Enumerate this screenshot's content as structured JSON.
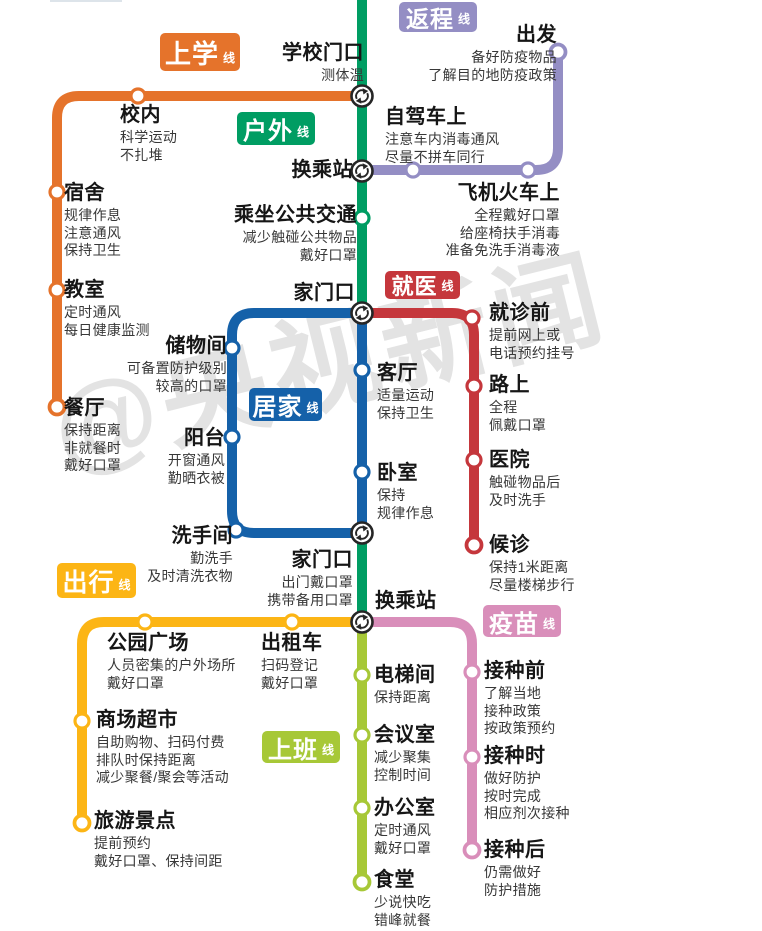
{
  "watermark": "@央视新闻",
  "badge_suffix": "线",
  "lines": {
    "school": {
      "badge": "上学",
      "color": "#E5732B",
      "stations": [
        {
          "name": "学校门口",
          "tips": [
            "测体温"
          ]
        },
        {
          "name": "校内",
          "tips": [
            "科学运动",
            "不扎堆"
          ]
        },
        {
          "name": "宿舍",
          "tips": [
            "规律作息",
            "注意通风",
            "保持卫生"
          ]
        },
        {
          "name": "教室",
          "tips": [
            "定时通风",
            "每日健康监测"
          ]
        },
        {
          "name": "餐厅",
          "tips": [
            "保持距离",
            "非就餐时",
            "戴好口罩"
          ]
        }
      ]
    },
    "outdoor": {
      "badge": "户外",
      "color": "#009D63",
      "stations": [
        {
          "name": "换乘站",
          "tips": []
        },
        {
          "name": "乘坐公共交通",
          "tips": [
            "减少触碰公共物品",
            "戴好口罩"
          ]
        },
        {
          "name": "家门口",
          "tips": []
        }
      ]
    },
    "return_trip": {
      "badge": "返程",
      "color": "#948EC4",
      "stations": [
        {
          "name": "出发",
          "tips": [
            "备好防疫物品",
            "了解目的地防疫政策"
          ]
        },
        {
          "name": "自驾车上",
          "tips": [
            "注意车内消毒通风",
            "尽量不拼车同行"
          ]
        },
        {
          "name": "飞机火车上",
          "tips": [
            "全程戴好口罩",
            "给座椅扶手消毒",
            "准备免洗手消毒液"
          ]
        }
      ]
    },
    "medical": {
      "badge": "就医",
      "color": "#C5373C",
      "stations": [
        {
          "name": "就诊前",
          "tips": [
            "提前网上或",
            "电话预约挂号"
          ]
        },
        {
          "name": "路上",
          "tips": [
            "全程",
            "佩戴口罩"
          ]
        },
        {
          "name": "医院",
          "tips": [
            "触碰物品后",
            "及时洗手"
          ]
        },
        {
          "name": "候诊",
          "tips": [
            "保持1米距离",
            "尽量楼梯步行"
          ]
        }
      ]
    },
    "home": {
      "badge": "居家",
      "color": "#1561A9",
      "stations": [
        {
          "name": "储物间",
          "tips": [
            "可备置防护级别",
            "较高的口罩"
          ]
        },
        {
          "name": "阳台",
          "tips": [
            "开窗通风",
            "勤晒衣被"
          ]
        },
        {
          "name": "洗手间",
          "tips": [
            "勤洗手",
            "及时清洗衣物"
          ]
        },
        {
          "name": "客厅",
          "tips": [
            "适量运动",
            "保持卫生"
          ]
        },
        {
          "name": "卧室",
          "tips": [
            "保持",
            "规律作息"
          ]
        },
        {
          "name": "家门口",
          "tips": [
            "出门戴口罩",
            "携带备用口罩"
          ]
        }
      ]
    },
    "travel": {
      "badge": "出行",
      "color": "#FCB515",
      "stations": [
        {
          "name": "公园广场",
          "tips": [
            "人员密集的户外场所",
            "戴好口罩"
          ]
        },
        {
          "name": "出租车",
          "tips": [
            "扫码登记",
            "戴好口罩"
          ]
        },
        {
          "name": "商场超市",
          "tips": [
            "自助购物、扫码付费",
            "排队时保持距离",
            "减少聚餐/聚会等活动"
          ]
        },
        {
          "name": "旅游景点",
          "tips": [
            "提前预约",
            "戴好口罩、保持间距"
          ]
        }
      ]
    },
    "vaccine": {
      "badge": "疫苗",
      "color": "#D98EBA",
      "stations": [
        {
          "name": "接种前",
          "tips": [
            "了解当地",
            "接种政策",
            "按政策预约"
          ]
        },
        {
          "name": "接种时",
          "tips": [
            "做好防护",
            "按时完成",
            "相应剂次接种"
          ]
        },
        {
          "name": "接种后",
          "tips": [
            "仍需做好",
            "防护措施"
          ]
        }
      ]
    },
    "work": {
      "badge": "上班",
      "color": "#A7C837",
      "stations": [
        {
          "name": "换乘站",
          "tips": []
        },
        {
          "name": "电梯间",
          "tips": [
            "保持距离"
          ]
        },
        {
          "name": "会议室",
          "tips": [
            "减少聚集",
            "控制时间"
          ]
        },
        {
          "name": "办公室",
          "tips": [
            "定时通风",
            "戴好口罩"
          ]
        },
        {
          "name": "食堂",
          "tips": [
            "少说快吃",
            "错峰就餐"
          ]
        }
      ]
    }
  }
}
